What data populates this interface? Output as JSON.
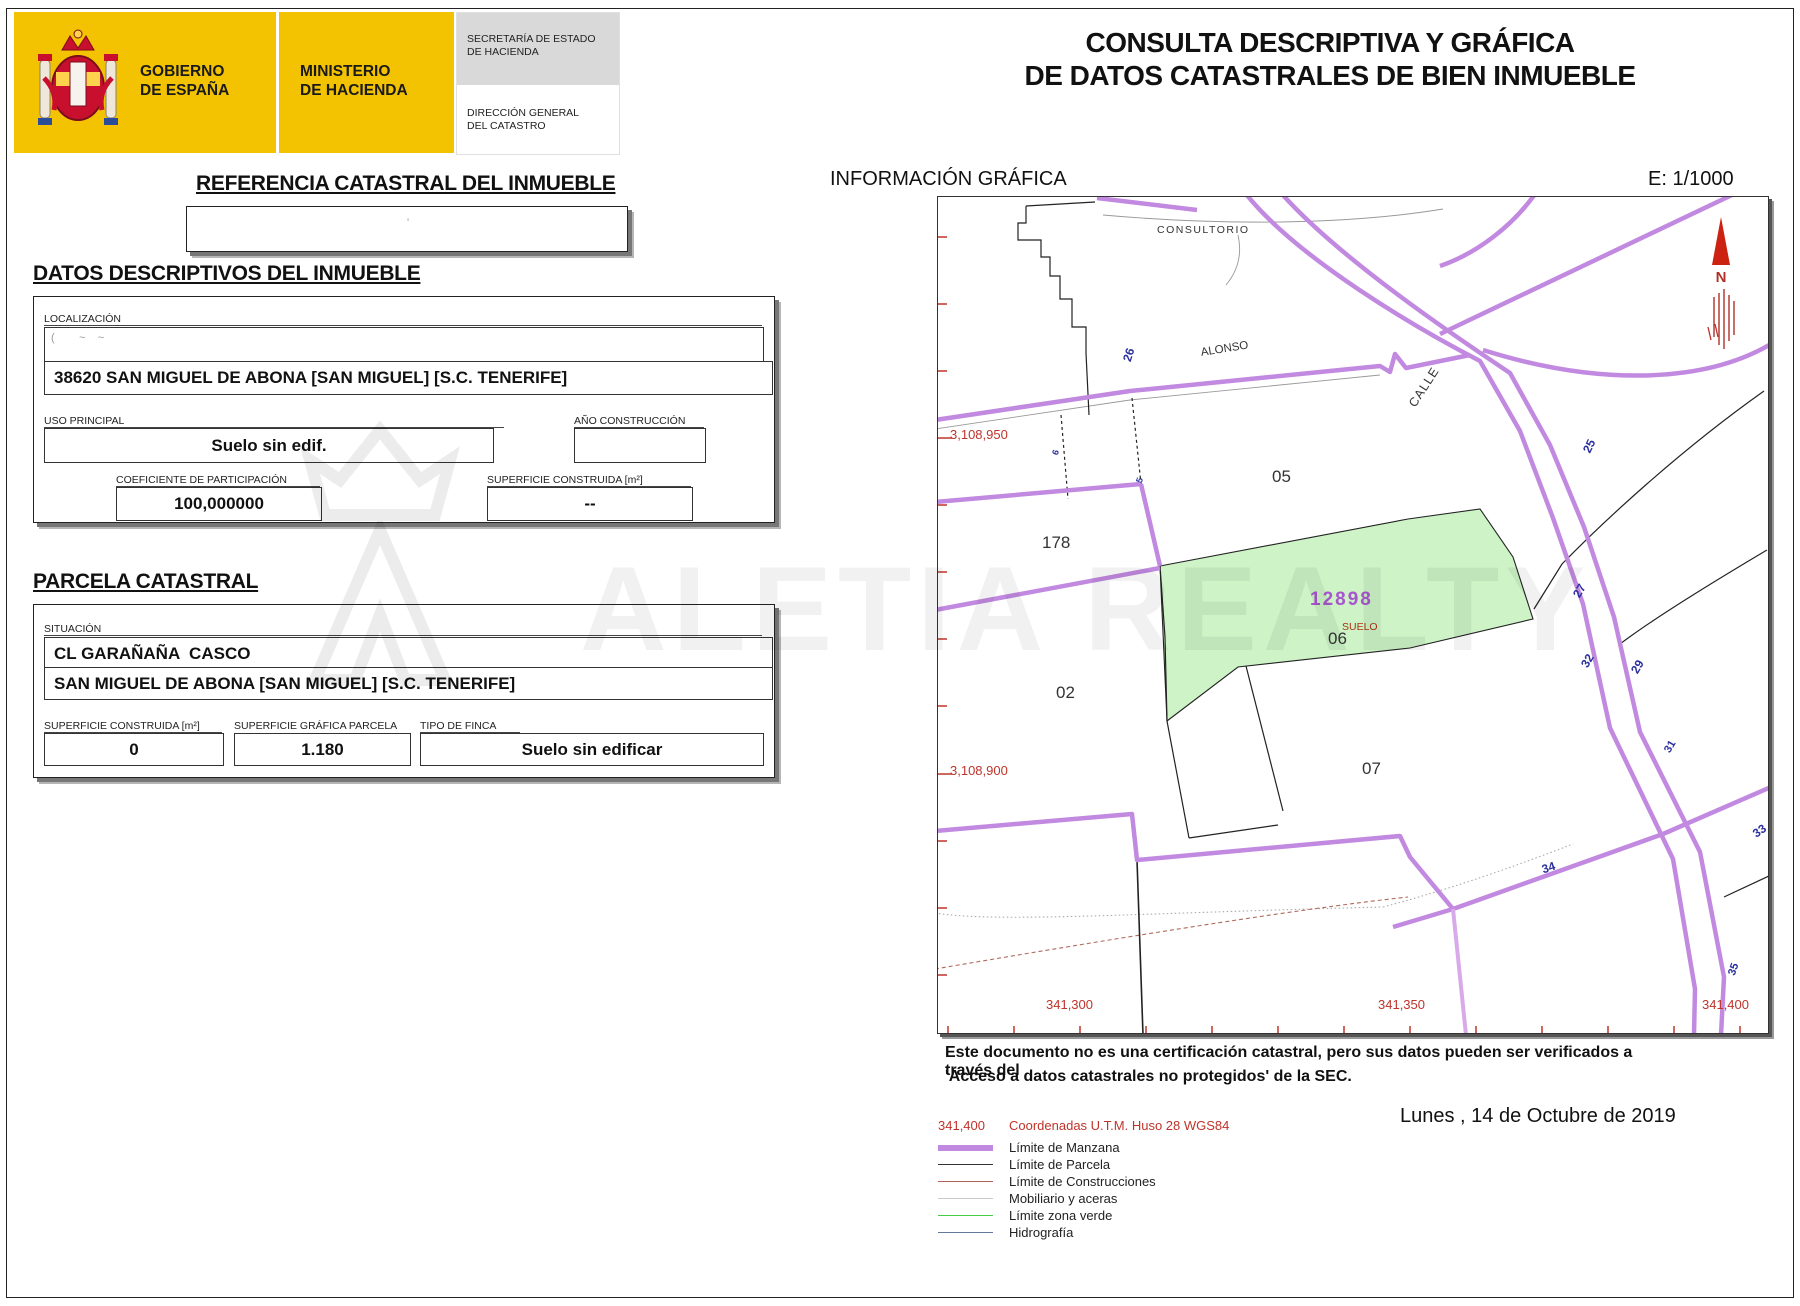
{
  "header": {
    "gobierno_l1": "GOBIERNO",
    "gobierno_l2": "DE ESPAÑA",
    "ministerio_l1": "MINISTERIO",
    "ministerio_l2": "DE HACIENDA",
    "secretaria_l1": "SECRETARÍA DE ESTADO",
    "secretaria_l2": "DE HACIENDA",
    "direccion_l1": "DIRECCIÓN GENERAL",
    "direccion_l2": "DEL CATASTRO",
    "band_color": "#f3c200"
  },
  "title": {
    "line1": "CONSULTA DESCRIPTIVA Y GRÁFICA",
    "line2": "DE DATOS CATASTRALES DE BIEN INMUEBLE"
  },
  "referencia": {
    "heading": "REFERENCIA CATASTRAL DEL INMUEBLE",
    "value_redacted": "'"
  },
  "datos": {
    "heading": "DATOS DESCRIPTIVOS DEL INMUEBLE",
    "localizacion_label": "LOCALIZACIÓN",
    "address_redacted": "(        ~    ~",
    "address_line2": "38620 SAN MIGUEL DE ABONA [SAN MIGUEL] [S.C. TENERIFE]",
    "uso_label": "USO PRINCIPAL",
    "uso_value": "Suelo sin edif.",
    "ano_label": "AÑO CONSTRUCCIÓN",
    "ano_value": "",
    "coef_label": "COEFICIENTE DE PARTICIPACIÓN",
    "coef_value": "100,000000",
    "sup_label": "SUPERFICIE CONSTRUIDA [m²]",
    "sup_value": "--"
  },
  "parcela": {
    "heading": "PARCELA CATASTRAL",
    "situacion_label": "SITUACIÓN",
    "situacion_line1": "CL GARAÑAÑA  CASCO",
    "situacion_line2": "SAN MIGUEL DE ABONA [SAN MIGUEL] [S.C. TENERIFE]",
    "sup_const_label": "SUPERFICIE CONSTRUIDA [m²]",
    "sup_const_value": "0",
    "sup_graf_label": "SUPERFICIE GRÁFICA PARCELA [m²]",
    "sup_graf_value": "1.180",
    "tipo_label": "TIPO DE FINCA",
    "tipo_value": "Suelo sin edificar"
  },
  "grafica": {
    "heading": "INFORMACIÓN GRÁFICA",
    "escala": "E: 1/1000",
    "north_letter": "N",
    "labels": {
      "consultorio": "CONSULTORIO",
      "alonso": "ALONSO",
      "calle": "CALLE",
      "p05": "05",
      "p178": "178",
      "p02": "02",
      "p07": "07",
      "main_ref": "12898",
      "main_suelo": "SUELO",
      "main_num": "06"
    },
    "house_numbers": {
      "n26": "26",
      "n25": "25",
      "n27": "27",
      "n32": "32",
      "n29": "29",
      "n34": "34",
      "n33": "33",
      "n35": "35",
      "n31": "31",
      "n5": "5",
      "n6": "6"
    },
    "coords": {
      "y1": "3,108,950",
      "y2": "3,108,900",
      "x1": "341,300",
      "x2": "341,350",
      "x3": "341,400"
    },
    "colors": {
      "manzana_purple": "#c289e0",
      "parcel_green_fill": "#cdf3c6",
      "coord_red": "#bf342a",
      "house_number_blue": "#2b2f9e",
      "main_ref_purple": "#a855cf",
      "suelo_red": "#aa3311"
    }
  },
  "footer": {
    "line1": "Este documento no es una certificación catastral, pero sus datos pueden ser verificados a través del",
    "line2": "'Acceso a datos catastrales no protegidos' de la SEC.",
    "date": "Lunes , 14 de Octubre de 2019"
  },
  "legend": {
    "coord_sample": "341,400",
    "coord_label": "Coordenadas U.T.M. Huso 28 WGS84",
    "items": [
      {
        "label": "Límite de Manzana",
        "color": "#c289e0",
        "thick": true
      },
      {
        "label": "Límite de Parcela",
        "color": "#333333",
        "thick": false
      },
      {
        "label": "Límite de Construcciones",
        "color": "#b0605a",
        "thick": false
      },
      {
        "label": "Mobiliario y aceras",
        "color": "#c8c8c8",
        "thick": false
      },
      {
        "label": "Límite zona verde",
        "color": "#44cc44",
        "thick": false
      },
      {
        "label": "Hidrografía",
        "color": "#667799",
        "thick": false
      }
    ]
  },
  "watermark": {
    "diagonal": "CONSULTA",
    "horizontal": "ALETIA REALTY"
  }
}
